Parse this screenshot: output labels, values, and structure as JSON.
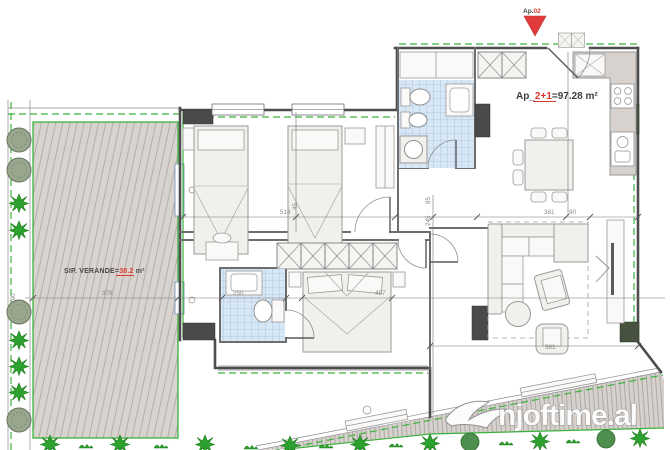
{
  "marker": {
    "prefix": "Ap.",
    "number": "02"
  },
  "apartment_label": {
    "prefix": "Ap_",
    "type": "2+1",
    "area_suffix": "=97.28 m²"
  },
  "veranda_label": {
    "prefix": "SIP. VERANDE=",
    "area": "38.2",
    "unit": " m²"
  },
  "watermark": {
    "text": "njoftime.al"
  },
  "dimensions": {
    "bedroom_width": "518",
    "veranda_width": "378",
    "bath2_width": "250",
    "bedroom3_width": "457",
    "corridor_a": "245",
    "corridor_b": "85",
    "living_width": "381",
    "living_wall": "90",
    "left_edge": "190",
    "door_width": "45",
    "living_bottom": "381"
  },
  "colors": {
    "accent_red": "#d93a2f",
    "boundary_green": "#3cb33c",
    "tile_blue": "#a8c6e0",
    "hatch_fill": "#d8d3cf",
    "wall_dark": "#4d4d4d",
    "dim_gray": "#8a8a8a",
    "watermark_white": "#ffffff"
  }
}
